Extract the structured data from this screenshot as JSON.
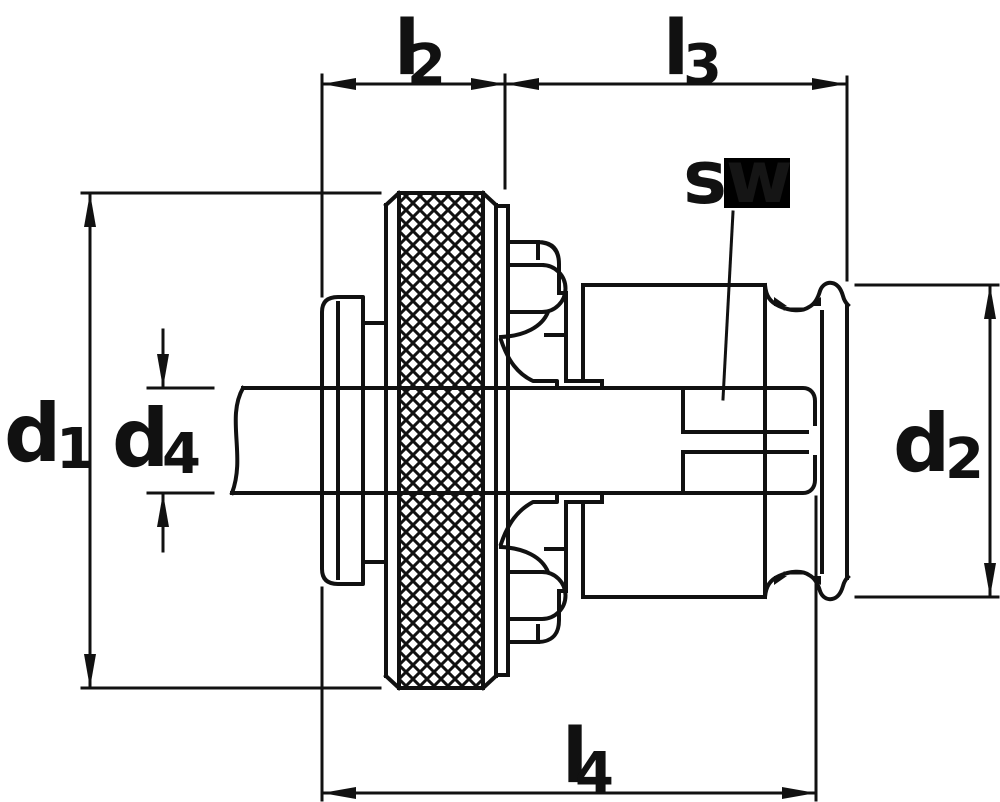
{
  "drawing": {
    "type": "technical-dimension-drawing",
    "background": "#ffffff",
    "line_color": "#111111",
    "highlight_box_color": "#000000",
    "labels": {
      "l2": {
        "main": "l",
        "sub": "2"
      },
      "l3": {
        "main": "l",
        "sub": "3"
      },
      "l4": {
        "main": "l",
        "sub": "4"
      },
      "d1": {
        "main": "d",
        "sub": "1"
      },
      "d2": {
        "main": "d",
        "sub": "2"
      },
      "d4": {
        "main": "d",
        "sub": "4"
      },
      "sw": {
        "s": "s",
        "w": "w"
      }
    }
  }
}
